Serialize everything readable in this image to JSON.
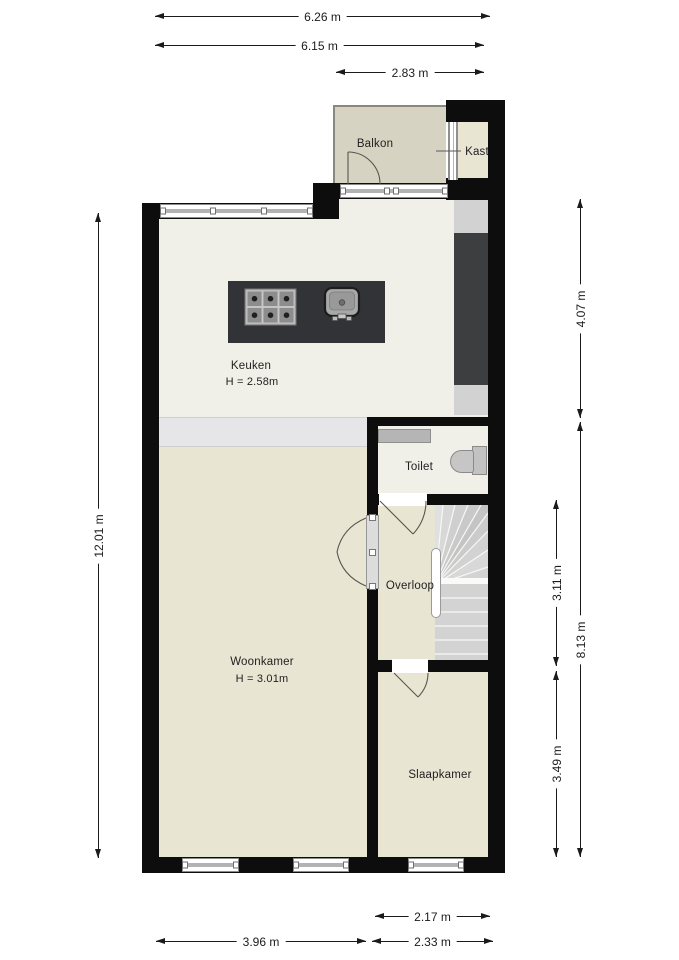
{
  "plan_type": "floor-plan",
  "rooms": {
    "balkon": {
      "label": "Balkon"
    },
    "kast": {
      "label": "Kast"
    },
    "keuken": {
      "label": "Keuken",
      "height": "H = 2.58m"
    },
    "toilet": {
      "label": "Toilet"
    },
    "overloop": {
      "label": "Overloop"
    },
    "woonkamer": {
      "label": "Woonkamer",
      "height": "H = 3.01m"
    },
    "slaapkamer": {
      "label": "Slaapkamer"
    }
  },
  "dimensions": {
    "top": [
      {
        "label": "6.26 m"
      },
      {
        "label": "6.15 m"
      },
      {
        "label": "2.83 m"
      }
    ],
    "left": [
      {
        "label": "12.01 m"
      }
    ],
    "right_outer": [
      {
        "label": "4.07 m"
      },
      {
        "label": "8.13 m"
      }
    ],
    "right_inner": [
      {
        "label": "3.11 m"
      },
      {
        "label": "3.49 m"
      }
    ],
    "bottom": [
      {
        "label": "2.17 m"
      },
      {
        "label": "3.96 m"
      },
      {
        "label": "2.33 m"
      }
    ]
  },
  "fixtures": [
    "stove-icon",
    "sink-icon",
    "toilet-icon",
    "stairs-icon",
    "handrail",
    "counter",
    "windows",
    "door-arcs"
  ],
  "colors": {
    "wall": "#0d0d0d",
    "room_floor_beige": "#e9e5d3",
    "keuken_floor": "#f0efe8",
    "balkon_floor": "#d7d3c3",
    "island_dark": "#323337",
    "appliance_strip_dark": "#3d3e40",
    "strip_light": "#d2d2d2",
    "step_band": "#e6e6e8",
    "stairs_gray": "#d3d3d3",
    "dimension_line": "#1b1b1b",
    "background": "#ffffff"
  }
}
